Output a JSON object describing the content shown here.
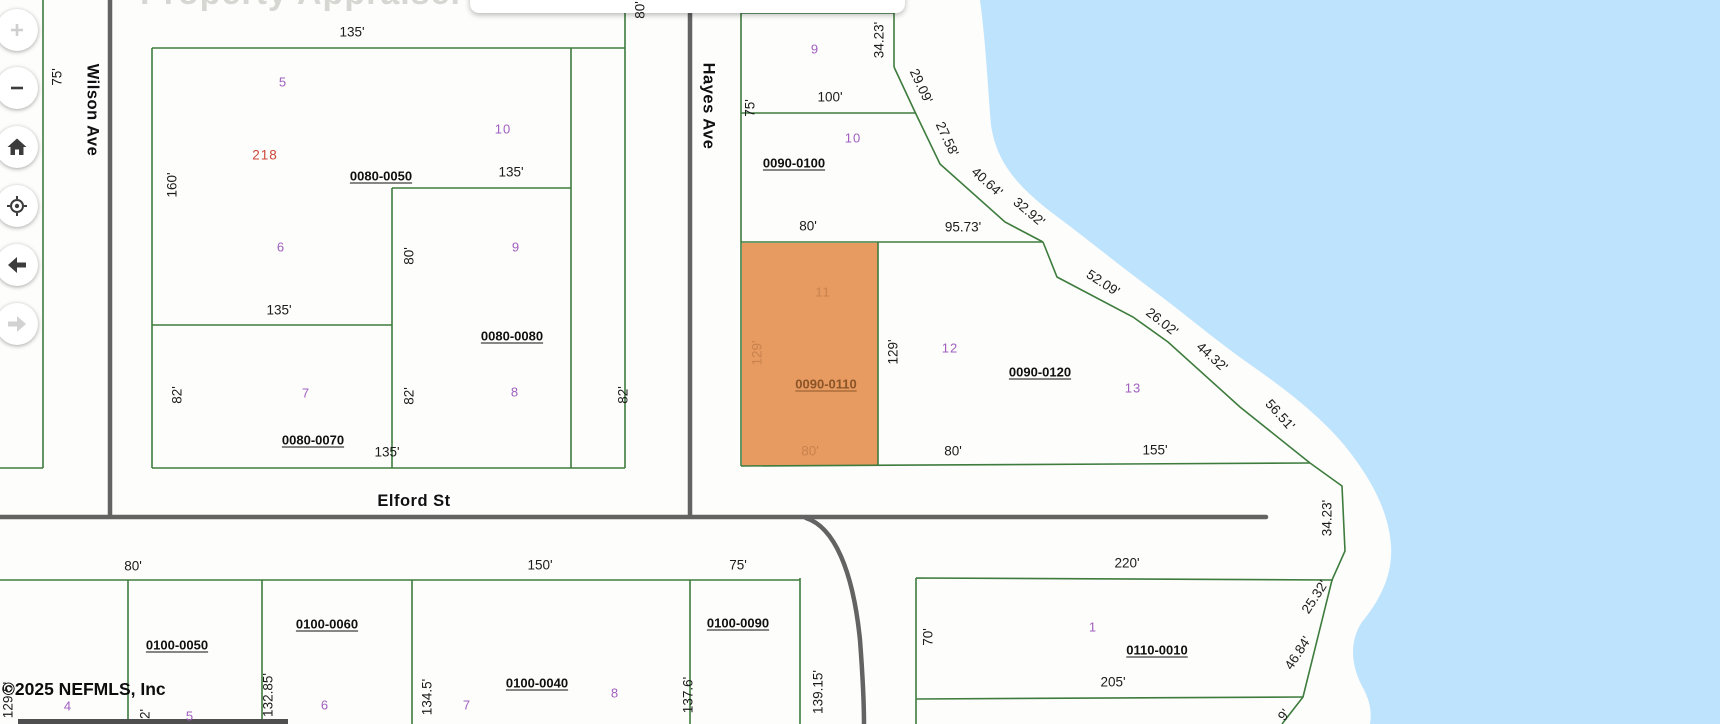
{
  "map": {
    "watermark": "Property Appraiser",
    "copyright": "©2025 NEFMLS, Inc",
    "colors": {
      "water": "#bee3fd",
      "parcel_line": "#3e7c3e",
      "road": "#636363",
      "highlight_fill": "#e89b61",
      "lot_number": "#a05fc0",
      "highlight_text": "#c8834e",
      "highlight_id": "#8a5427",
      "address_red": "#cc4638"
    },
    "highlighted_parcel": "0090-0110",
    "streets": [
      {
        "text": "Wilson Ave",
        "x": 92,
        "y": 110,
        "rot": 90
      },
      {
        "text": "Hayes Ave",
        "x": 708,
        "y": 106,
        "rot": 90
      },
      {
        "text": "Elford St",
        "x": 414,
        "y": 501,
        "rot": 0
      }
    ],
    "parcel_ids": [
      {
        "text": "0080-0050",
        "x": 381,
        "y": 176
      },
      {
        "text": "0080-0080",
        "x": 512,
        "y": 336
      },
      {
        "text": "0080-0070",
        "x": 313,
        "y": 440
      },
      {
        "text": "0090-0100",
        "x": 794,
        "y": 163
      },
      {
        "text": "0090-0110",
        "x": 826,
        "y": 384,
        "tint": true
      },
      {
        "text": "0090-0120",
        "x": 1040,
        "y": 372
      },
      {
        "text": "0110-0010",
        "x": 1157,
        "y": 650
      },
      {
        "text": "0100-0050",
        "x": 177,
        "y": 645
      },
      {
        "text": "0100-0060",
        "x": 327,
        "y": 624
      },
      {
        "text": "0100-0040",
        "x": 537,
        "y": 683
      },
      {
        "text": "0100-0090",
        "x": 738,
        "y": 623
      }
    ],
    "lot_numbers": [
      {
        "text": "5",
        "x": 283,
        "y": 82
      },
      {
        "text": "10",
        "x": 503,
        "y": 129
      },
      {
        "text": "6",
        "x": 281,
        "y": 247
      },
      {
        "text": "9",
        "x": 516,
        "y": 247
      },
      {
        "text": "7",
        "x": 306,
        "y": 393
      },
      {
        "text": "8",
        "x": 515,
        "y": 392
      },
      {
        "text": "9",
        "x": 815,
        "y": 49
      },
      {
        "text": "10",
        "x": 853,
        "y": 138
      },
      {
        "text": "11",
        "x": 823,
        "y": 292,
        "tint": true
      },
      {
        "text": "12",
        "x": 950,
        "y": 348
      },
      {
        "text": "13",
        "x": 1133,
        "y": 388
      },
      {
        "text": "1",
        "x": 1093,
        "y": 627
      },
      {
        "text": "4",
        "x": 68,
        "y": 706
      },
      {
        "text": "5",
        "x": 190,
        "y": 716
      },
      {
        "text": "6",
        "x": 325,
        "y": 705
      },
      {
        "text": "7",
        "x": 467,
        "y": 705
      },
      {
        "text": "8",
        "x": 615,
        "y": 693
      }
    ],
    "address_label": {
      "text": "218",
      "x": 265,
      "y": 155
    },
    "dimensions": [
      {
        "text": "135'",
        "x": 352,
        "y": 32
      },
      {
        "text": "75'",
        "x": 57,
        "y": 77,
        "rot": -90
      },
      {
        "text": "160'",
        "x": 172,
        "y": 185,
        "rot": -90
      },
      {
        "text": "135'",
        "x": 511,
        "y": 172
      },
      {
        "text": "80'",
        "x": 409,
        "y": 256,
        "rot": -90
      },
      {
        "text": "135'",
        "x": 279,
        "y": 310
      },
      {
        "text": "82'",
        "x": 177,
        "y": 395,
        "rot": -90
      },
      {
        "text": "82'",
        "x": 409,
        "y": 396,
        "rot": -90
      },
      {
        "text": "82'",
        "x": 623,
        "y": 395,
        "rot": -90
      },
      {
        "text": "135'",
        "x": 387,
        "y": 452
      },
      {
        "text": "80'",
        "x": 640,
        "y": 10,
        "rot": -90
      },
      {
        "text": "75'",
        "x": 750,
        "y": 108,
        "rot": -90
      },
      {
        "text": "100'",
        "x": 830,
        "y": 97
      },
      {
        "text": "34.23'",
        "x": 879,
        "y": 40,
        "rot": -90
      },
      {
        "text": "29.09'",
        "x": 921,
        "y": 86,
        "rot": 65
      },
      {
        "text": "27.58'",
        "x": 947,
        "y": 139,
        "rot": 65
      },
      {
        "text": "40.64'",
        "x": 987,
        "y": 182,
        "rot": 42
      },
      {
        "text": "32.92'",
        "x": 1029,
        "y": 212,
        "rot": 40
      },
      {
        "text": "80'",
        "x": 808,
        "y": 226
      },
      {
        "text": "95.73'",
        "x": 963,
        "y": 227
      },
      {
        "text": "129'",
        "x": 757,
        "y": 353,
        "rot": -90,
        "tint": true
      },
      {
        "text": "129'",
        "x": 893,
        "y": 352,
        "rot": -90
      },
      {
        "text": "80'",
        "x": 810,
        "y": 451,
        "tint": true
      },
      {
        "text": "80'",
        "x": 953,
        "y": 451
      },
      {
        "text": "155'",
        "x": 1155,
        "y": 450
      },
      {
        "text": "52.09'",
        "x": 1103,
        "y": 283,
        "rot": 33
      },
      {
        "text": "26.02'",
        "x": 1162,
        "y": 322,
        "rot": 38
      },
      {
        "text": "44.32'",
        "x": 1212,
        "y": 357,
        "rot": 42
      },
      {
        "text": "56.51'",
        "x": 1280,
        "y": 415,
        "rot": 48
      },
      {
        "text": "34.23'",
        "x": 1327,
        "y": 518,
        "rot": -90
      },
      {
        "text": "25.32'",
        "x": 1315,
        "y": 597,
        "rot": -57
      },
      {
        "text": "46.84'",
        "x": 1298,
        "y": 653,
        "rot": -57
      },
      {
        "text": "220'",
        "x": 1127,
        "y": 563
      },
      {
        "text": "70'",
        "x": 928,
        "y": 637,
        "rot": -90
      },
      {
        "text": "205'",
        "x": 1113,
        "y": 682
      },
      {
        "text": "80'",
        "x": 133,
        "y": 566
      },
      {
        "text": "150'",
        "x": 540,
        "y": 565
      },
      {
        "text": "75'",
        "x": 738,
        "y": 565
      },
      {
        "text": "132.85'",
        "x": 268,
        "y": 695,
        "rot": -90
      },
      {
        "text": "134.5'",
        "x": 427,
        "y": 697,
        "rot": -90
      },
      {
        "text": "137.6'",
        "x": 688,
        "y": 695,
        "rot": -90
      },
      {
        "text": "139.15'",
        "x": 818,
        "y": 692,
        "rot": -90
      },
      {
        "text": "129.5'",
        "x": 8,
        "y": 700,
        "rot": -90
      },
      {
        "text": "2'",
        "x": 145,
        "y": 714,
        "rot": -90
      },
      {
        "text": "9'",
        "x": 1284,
        "y": 715,
        "rot": -52
      }
    ]
  },
  "toolbar": {
    "buttons": [
      {
        "name": "zoom-in",
        "disabled": true
      },
      {
        "name": "zoom-out",
        "disabled": false
      },
      {
        "name": "home",
        "disabled": false
      },
      {
        "name": "locate",
        "disabled": false
      },
      {
        "name": "back",
        "disabled": false
      },
      {
        "name": "forward",
        "disabled": true
      }
    ]
  }
}
